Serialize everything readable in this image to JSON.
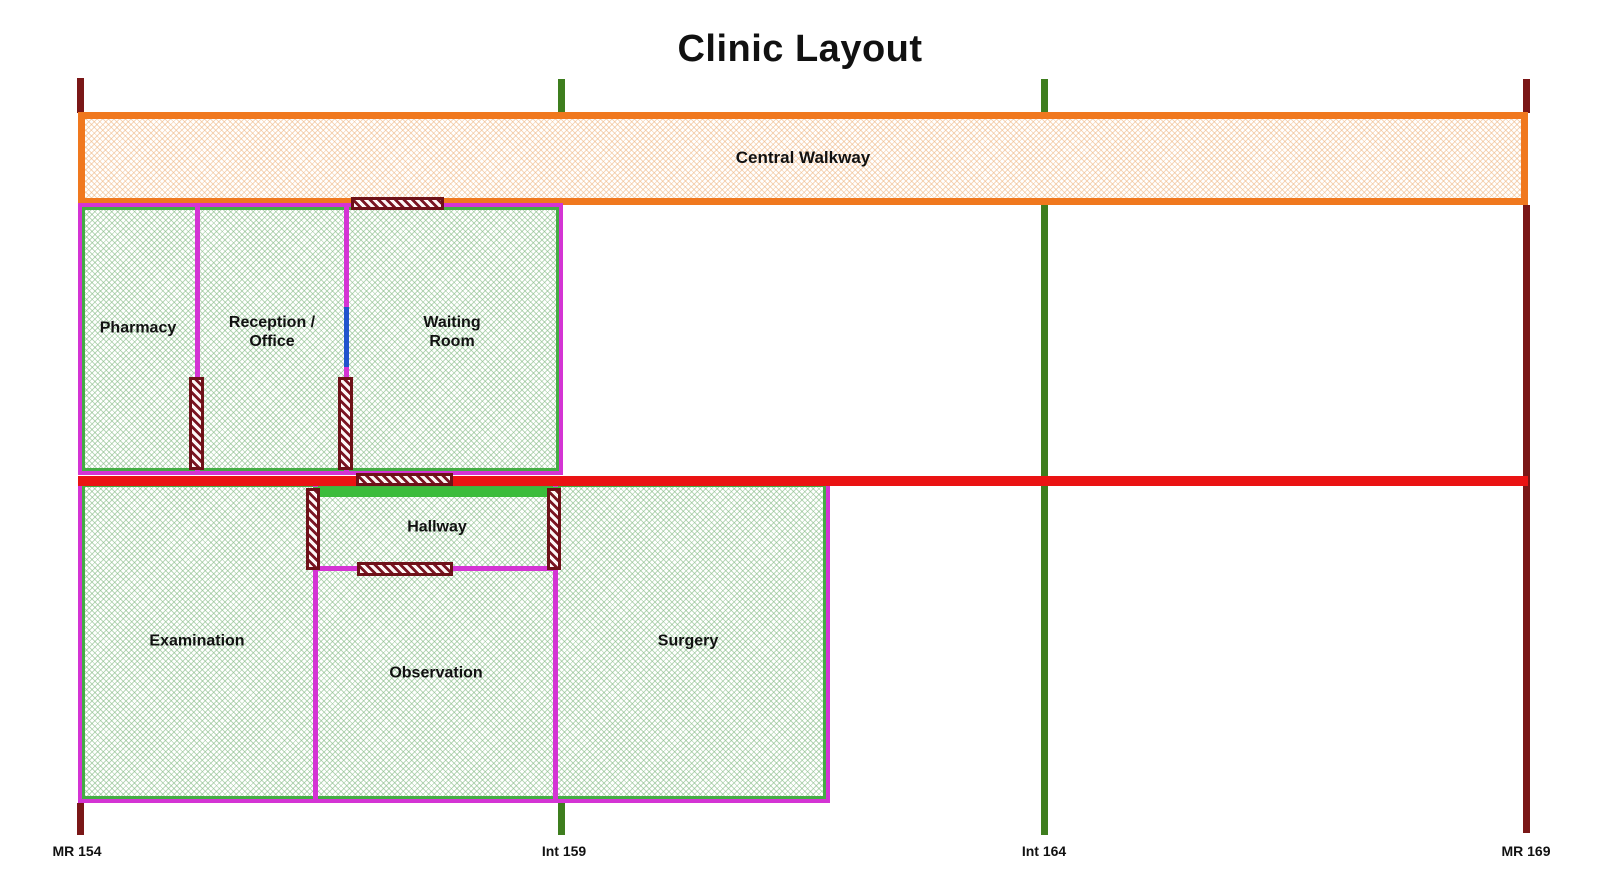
{
  "title": "Clinic Layout",
  "walkway": {
    "label": "Central Walkway"
  },
  "rooms": {
    "pharmacy": {
      "label": "Pharmacy"
    },
    "reception": {
      "lines": [
        "Reception /",
        "Office"
      ]
    },
    "waiting": {
      "lines": [
        "Waiting",
        "Room"
      ]
    },
    "hallway": {
      "label": "Hallway"
    },
    "examination": {
      "label": "Examination"
    },
    "observation": {
      "label": "Observation"
    },
    "surgery": {
      "label": "Surgery"
    }
  },
  "boundaries": [
    {
      "id": "mr-154",
      "label": "MR 154",
      "color": "#7a1717"
    },
    {
      "id": "int-159",
      "label": "Int 159",
      "color": "#3e7e1e"
    },
    {
      "id": "int-164",
      "label": "Int 164",
      "color": "#3e7e1e"
    },
    {
      "id": "mr-169",
      "label": "MR 169",
      "color": "#7a1717"
    }
  ],
  "colors": {
    "walkway_border": "#f0781e",
    "room_border_magenta": "#d434d4",
    "room_border_green": "#44ad44",
    "wall_red": "#ea1313",
    "hallway_green_segment": "#3bbc3b",
    "door_maroon": "#6e1118",
    "window_blue": "#2154cd",
    "marker_maroon": "#7a1717",
    "marker_green": "#3e7e1e"
  }
}
